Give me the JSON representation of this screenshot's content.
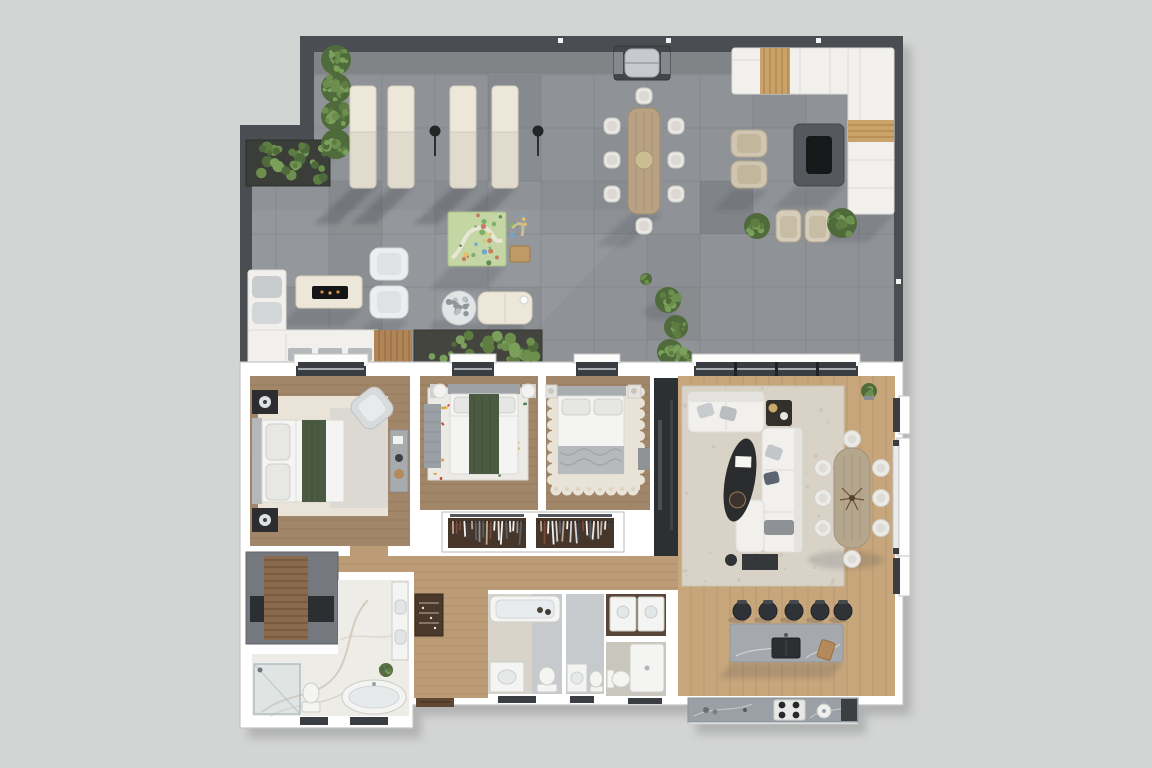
{
  "meta": {
    "description": "Top-down 3D rendered floor plan of an apartment with a large wrap-around roof terrace",
    "view": "top-down render",
    "visible_text_labels": []
  },
  "colors": {
    "background": "#d3d4d4",
    "terrace_wall": "#4a4e53",
    "terrace_floor": "#8f9397",
    "tile_line": "#7e8287",
    "interior_wall": "#ffffff",
    "wall_outline": "#c4c5c3",
    "wood_bedroom": "#a28669",
    "wood_living": "#c7a67c",
    "wood_corridor": "#bb9c76",
    "cream": "#ece7d9",
    "sofa_white": "#f1f0ed",
    "bed_runner": "#4b5a43",
    "rug_cream": "#e9e4d7",
    "rug_living": "#d9d3c7",
    "rug_terrazzo": "#eceae4",
    "marble": "#a5a9ad",
    "marble_bath": "#edece7",
    "closet_brown": "#46362a",
    "dark_fixture": "#2f3235",
    "window_frame": "#3a3e42",
    "greenery": "#6d8f4e",
    "greenery_dark": "#4f6b3b",
    "stool_black": "#2f3337",
    "wood_accent": "#c9a36a",
    "wood_table": "#b9a183",
    "stair_gray": "#75797f",
    "stair_wood": "#8a6a4c",
    "laundry_floor": "#5a4638",
    "bath_floor": "#d8d4c9",
    "bath_floor_2": "#c6cacc"
  },
  "terrace": {
    "name": "roof-terrace",
    "furniture": [
      {
        "name": "sun-lounger",
        "count": 4
      },
      {
        "name": "charcoal-torch",
        "count": 2
      },
      {
        "name": "bbq-grill",
        "count": 1
      },
      {
        "name": "outdoor-dining-table",
        "seats": 8
      },
      {
        "name": "u-shaped-outdoor-sofa",
        "count": 1
      },
      {
        "name": "fire-pit-table",
        "count": 2
      },
      {
        "name": "wicker-armchair",
        "count": 4
      },
      {
        "name": "white-lounge-armchair",
        "count": 2
      },
      {
        "name": "corner-sofa",
        "count": 1
      },
      {
        "name": "kids-play-mat",
        "count": 1
      },
      {
        "name": "pebble-side-table",
        "count": 1
      },
      {
        "name": "ottoman-daybed",
        "count": 1
      },
      {
        "name": "planter-box",
        "count": 2
      },
      {
        "name": "wood-deck-strip",
        "count": 1
      },
      {
        "name": "topiary-shrub",
        "count": 10
      }
    ]
  },
  "interior": {
    "rooms": [
      {
        "id": "bedroom-1",
        "furniture": [
          "double-bed",
          "nightstand",
          "nightstand",
          "armchair",
          "dresser",
          "area-rug"
        ]
      },
      {
        "id": "bedroom-2",
        "furniture": [
          "double-bed",
          "nightstand",
          "nightstand",
          "terrazzo-rug",
          "runner-rug"
        ]
      },
      {
        "id": "bedroom-3",
        "furniture": [
          "double-bed",
          "nightstand",
          "nightstand",
          "scalloped-rug",
          "side-table"
        ]
      },
      {
        "id": "wardrobe-closet-1",
        "furniture": [
          "hanging-clothes"
        ]
      },
      {
        "id": "wardrobe-closet-2",
        "furniture": [
          "hanging-clothes"
        ]
      },
      {
        "id": "living-room",
        "furniture": [
          "loveseat",
          "chaise-sofa",
          "coffee-table",
          "side-table",
          "media-console",
          "area-rug",
          "media-wall"
        ]
      },
      {
        "id": "dining-area",
        "furniture": [
          "dining-table",
          "dining-chair x8",
          "potted-plant"
        ]
      },
      {
        "id": "kitchen",
        "furniture": [
          "island-with-sink",
          "bar-stool x5",
          "cooktop-counter",
          "gas-hob",
          "round-sink"
        ]
      },
      {
        "id": "hallway",
        "furniture": [
          "console-shelf",
          "entry-door"
        ]
      },
      {
        "id": "bathroom-1",
        "furniture": [
          "bathtub",
          "vanity-sink",
          "toilet"
        ]
      },
      {
        "id": "bathroom-2",
        "furniture": [
          "vanity-sink",
          "toilet"
        ]
      },
      {
        "id": "laundry-room",
        "furniture": [
          "washer",
          "dryer"
        ]
      },
      {
        "id": "wc",
        "furniture": [
          "toilet",
          "shower-tray"
        ]
      },
      {
        "id": "master-bathroom",
        "furniture": [
          "walk-in-shower",
          "freestanding-bathtub",
          "toilet",
          "double-vanity",
          "plant"
        ]
      },
      {
        "id": "staircase",
        "furniture": [
          "stair-flight"
        ]
      }
    ]
  }
}
